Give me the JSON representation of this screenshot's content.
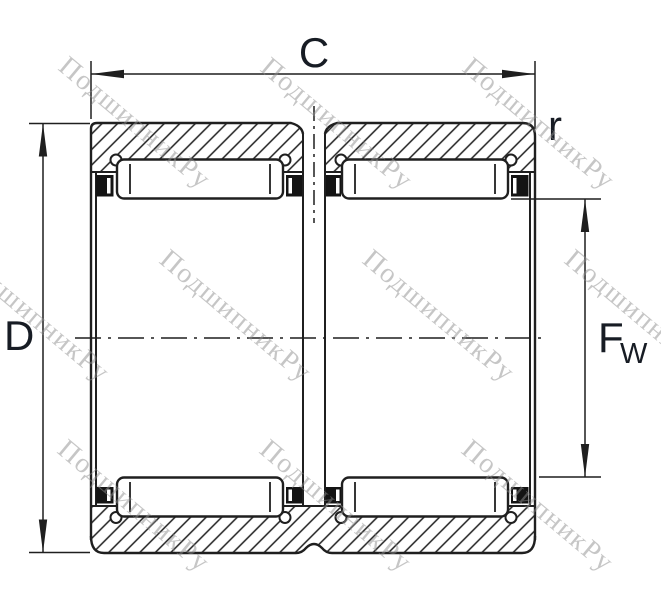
{
  "drawing": {
    "labels": {
      "outer_width": "C",
      "outer_diameter": "D",
      "corner_radius": "r",
      "bore_diameter_main": "F",
      "bore_diameter_sub": "W"
    },
    "watermark": {
      "text": "ПодшипникРу"
    },
    "colors": {
      "line": "#1f1f1f",
      "label": "#171c24",
      "cage_fill": "#141414",
      "watermark": "#8e8e8e",
      "background": "#ffffff"
    }
  }
}
